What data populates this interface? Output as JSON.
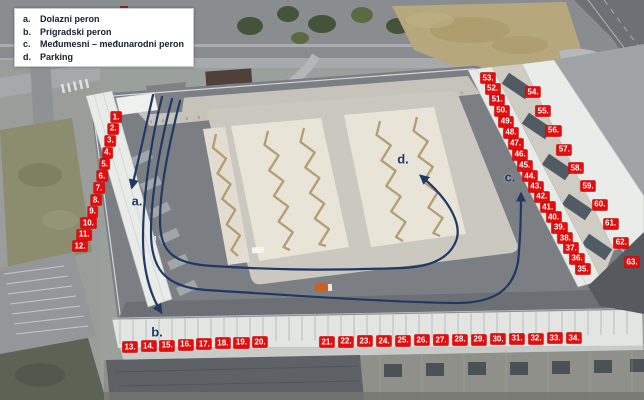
{
  "legend": {
    "items": [
      {
        "letter": "a.",
        "text": "Dolazni peron"
      },
      {
        "letter": "b.",
        "text": "Prigradski peron"
      },
      {
        "letter": "c.",
        "text": "Međumesni – međunarodni peron"
      },
      {
        "letter": "d.",
        "text": "Parking"
      }
    ]
  },
  "route_markers": [
    {
      "id": "a",
      "label": "a."
    },
    {
      "id": "b",
      "label": "b."
    },
    {
      "id": "c",
      "label": "c."
    },
    {
      "id": "d",
      "label": "d."
    }
  ],
  "platform_labels": {
    "left": [
      "1.",
      "2.",
      "3.",
      "4.",
      "5.",
      "6.",
      "7.",
      "8.",
      "9.",
      "10.",
      "11.",
      "12."
    ],
    "bottom_left": [
      "13.",
      "14.",
      "15.",
      "16.",
      "17.",
      "18.",
      "19.",
      "20."
    ],
    "bottom_right": [
      "21.",
      "22.",
      "23.",
      "24.",
      "25.",
      "26.",
      "27.",
      "28.",
      "29.",
      "30.",
      "31.",
      "32.",
      "33.",
      "34."
    ],
    "right_inner": [
      "35.",
      "36.",
      "37.",
      "38.",
      "39.",
      "40.",
      "41.",
      "42.",
      "43.",
      "44.",
      "45.",
      "46.",
      "47.",
      "48.",
      "49.",
      "50.",
      "51.",
      "52.",
      "53."
    ],
    "right_outer": [
      "54.",
      "55.",
      "56.",
      "57.",
      "58.",
      "59.",
      "60.",
      "61.",
      "62.",
      "63."
    ]
  },
  "colors": {
    "platform_label_bg": "#e60c0c",
    "platform_label_text": "#ffffff",
    "route_color": "#203864",
    "legend_text": "#15202e"
  }
}
